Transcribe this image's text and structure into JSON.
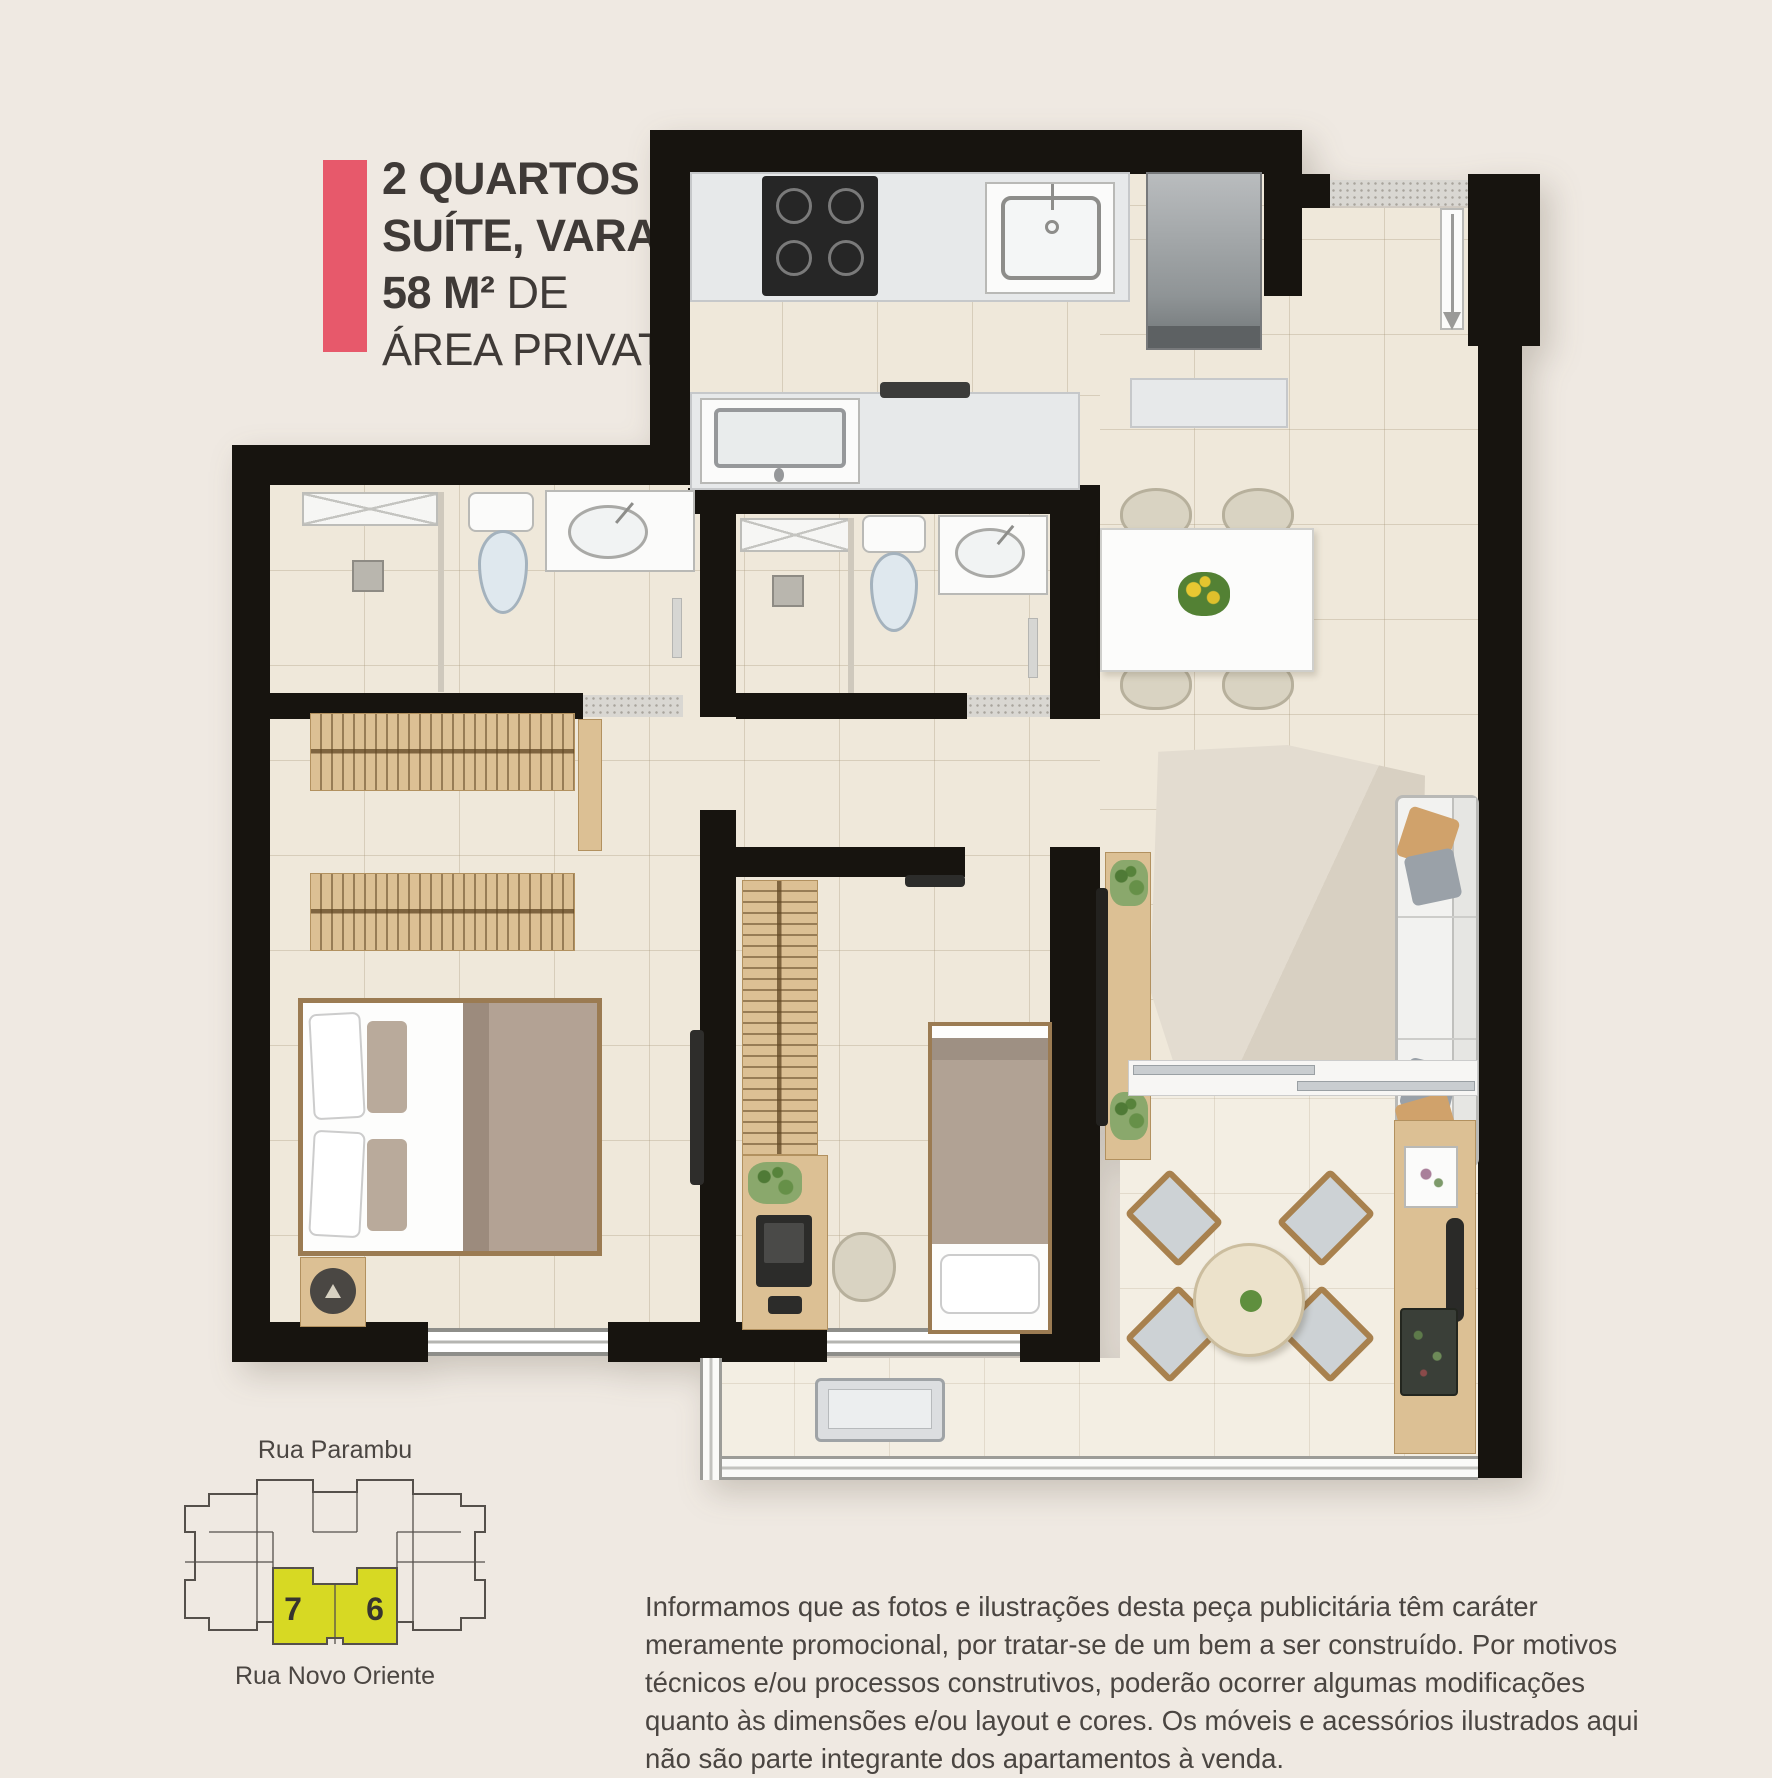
{
  "header": {
    "accent_color": "#e7596b",
    "text_color": "#3f3a37",
    "line1": "2 QUARTOS",
    "line2": "SUÍTE, VARANDA",
    "line3_strong": "58 M²",
    "line3_rest": "DE",
    "line4": "ÁREA PRIVATIVA"
  },
  "key_plan": {
    "street_top": "Rua Parambu",
    "street_bottom": "Rua Novo Oriente",
    "unit_left": "7",
    "unit_right": "6",
    "highlight_color": "#d7d923",
    "outline_color": "#55504b"
  },
  "disclaimer": "Informamos que as fotos e ilustrações desta peça publicitária têm caráter meramente promocional, por tratar-se de um bem a ser construído. Por motivos técnicos e/ou processos construtivos, poderão ocorrer algumas modificações quanto às dimensões e/ou layout e cores. Os móveis e acessórios ilustrados aqui não são parte integrante dos apartamentos à venda.",
  "floor_plan": {
    "wall_color": "#17140f",
    "floor_color": "#efe8da",
    "balcony_floor_color": "#f3eee3",
    "counter_color": "#e7e9ea",
    "wood_color": "#dcc094",
    "furniture_icons": [
      "cooktop-icon",
      "kitchen-sink-icon",
      "refrigerator-icon",
      "laundry-tank-icon",
      "serving-shelf-icon",
      "dining-table-icon",
      "dining-chair-icon",
      "flower-centerpiece-icon",
      "entry-door-icon",
      "shower-glass-icon",
      "shower-head-icon",
      "toilet-icon",
      "washbasin-icon",
      "towel-rail-icon",
      "wardrobe-icon",
      "door-leaf-icon",
      "double-bed-icon",
      "bedside-rug-icon",
      "wall-tv-icon",
      "desk-icon",
      "laptop-icon",
      "desk-chair-icon",
      "single-bed-icon",
      "tv-rack-icon",
      "plant-icon",
      "area-rug-icon",
      "sofa-icon",
      "sliding-door-icon",
      "round-table-icon",
      "patio-chair-icon",
      "buffet-counter-icon",
      "decor-frame-icon",
      "grill-icon",
      "serving-tray-icon",
      "ac-condenser-icon",
      "glass-railing-icon",
      "window-icon"
    ]
  }
}
